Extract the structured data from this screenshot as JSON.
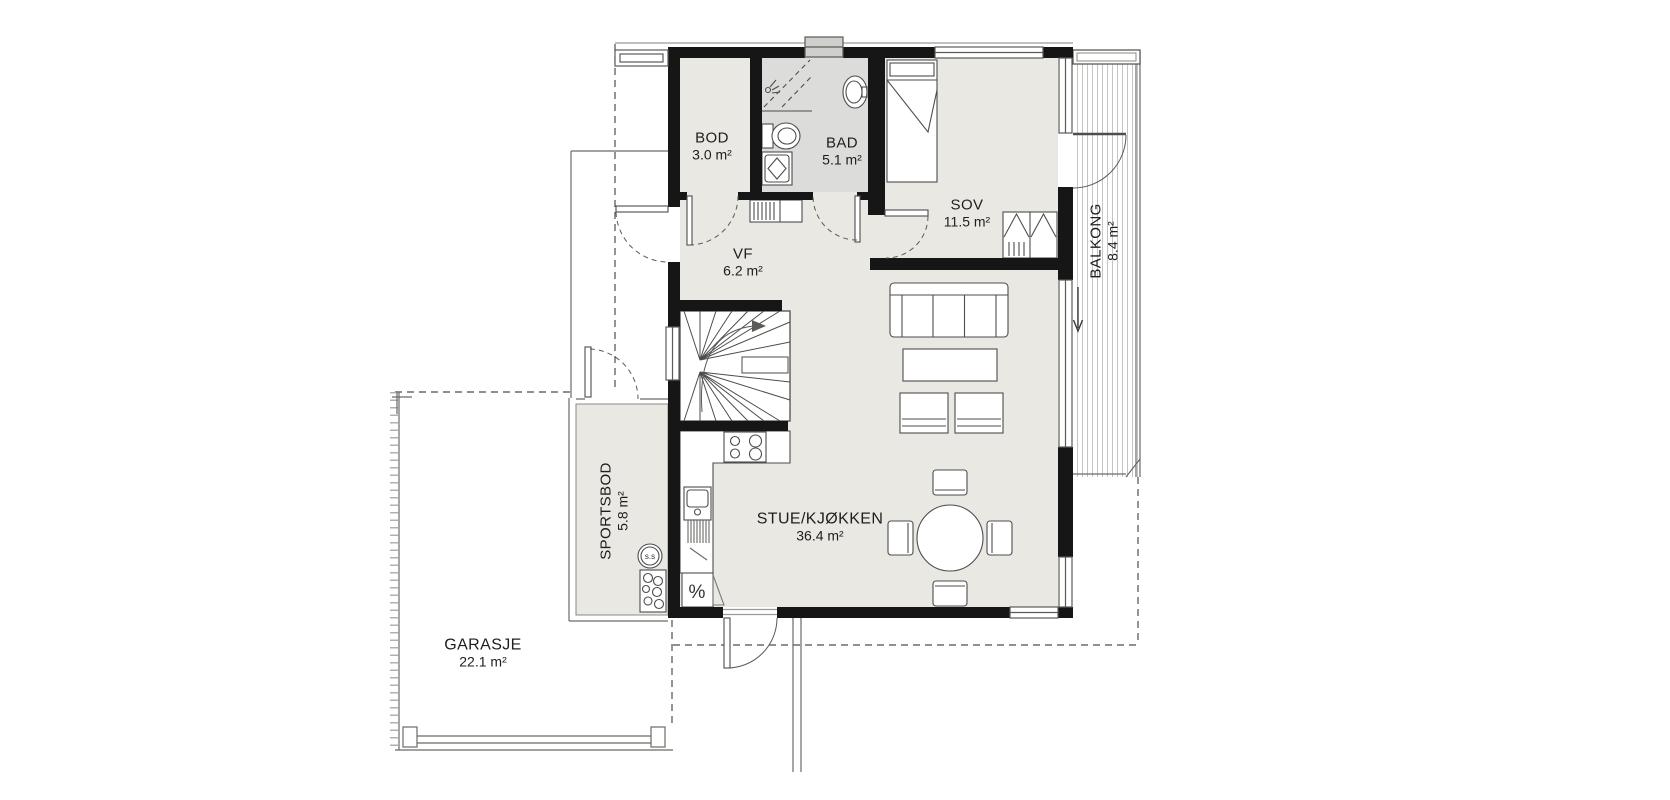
{
  "plan": {
    "rooms": [
      {
        "id": "bod",
        "name": "BOD",
        "area": "3.0 m²"
      },
      {
        "id": "bad",
        "name": "BAD",
        "area": "5.1 m²"
      },
      {
        "id": "sov",
        "name": "SOV",
        "area": "11.5 m²"
      },
      {
        "id": "vf",
        "name": "VF",
        "area": "6.2 m²"
      },
      {
        "id": "balkong",
        "name": "BALKONG",
        "area": "8.4 m²"
      },
      {
        "id": "sportsbod",
        "name": "SPORTSBOD",
        "area": "5.8 m²"
      },
      {
        "id": "stue_kjokken",
        "name": "STUE/KJØKKEN",
        "area": "36.4 m²"
      },
      {
        "id": "garasje",
        "name": "GARASJE",
        "area": "22.1 m²"
      }
    ],
    "symbols": {
      "ss_circle": "s.s",
      "dishwasher": "%"
    },
    "colors": {
      "wall": "#161616",
      "floor": "#e9e8e3",
      "bathroom_floor": "#dcdcda",
      "line": "#4d4d4d",
      "background": "#ffffff"
    }
  }
}
